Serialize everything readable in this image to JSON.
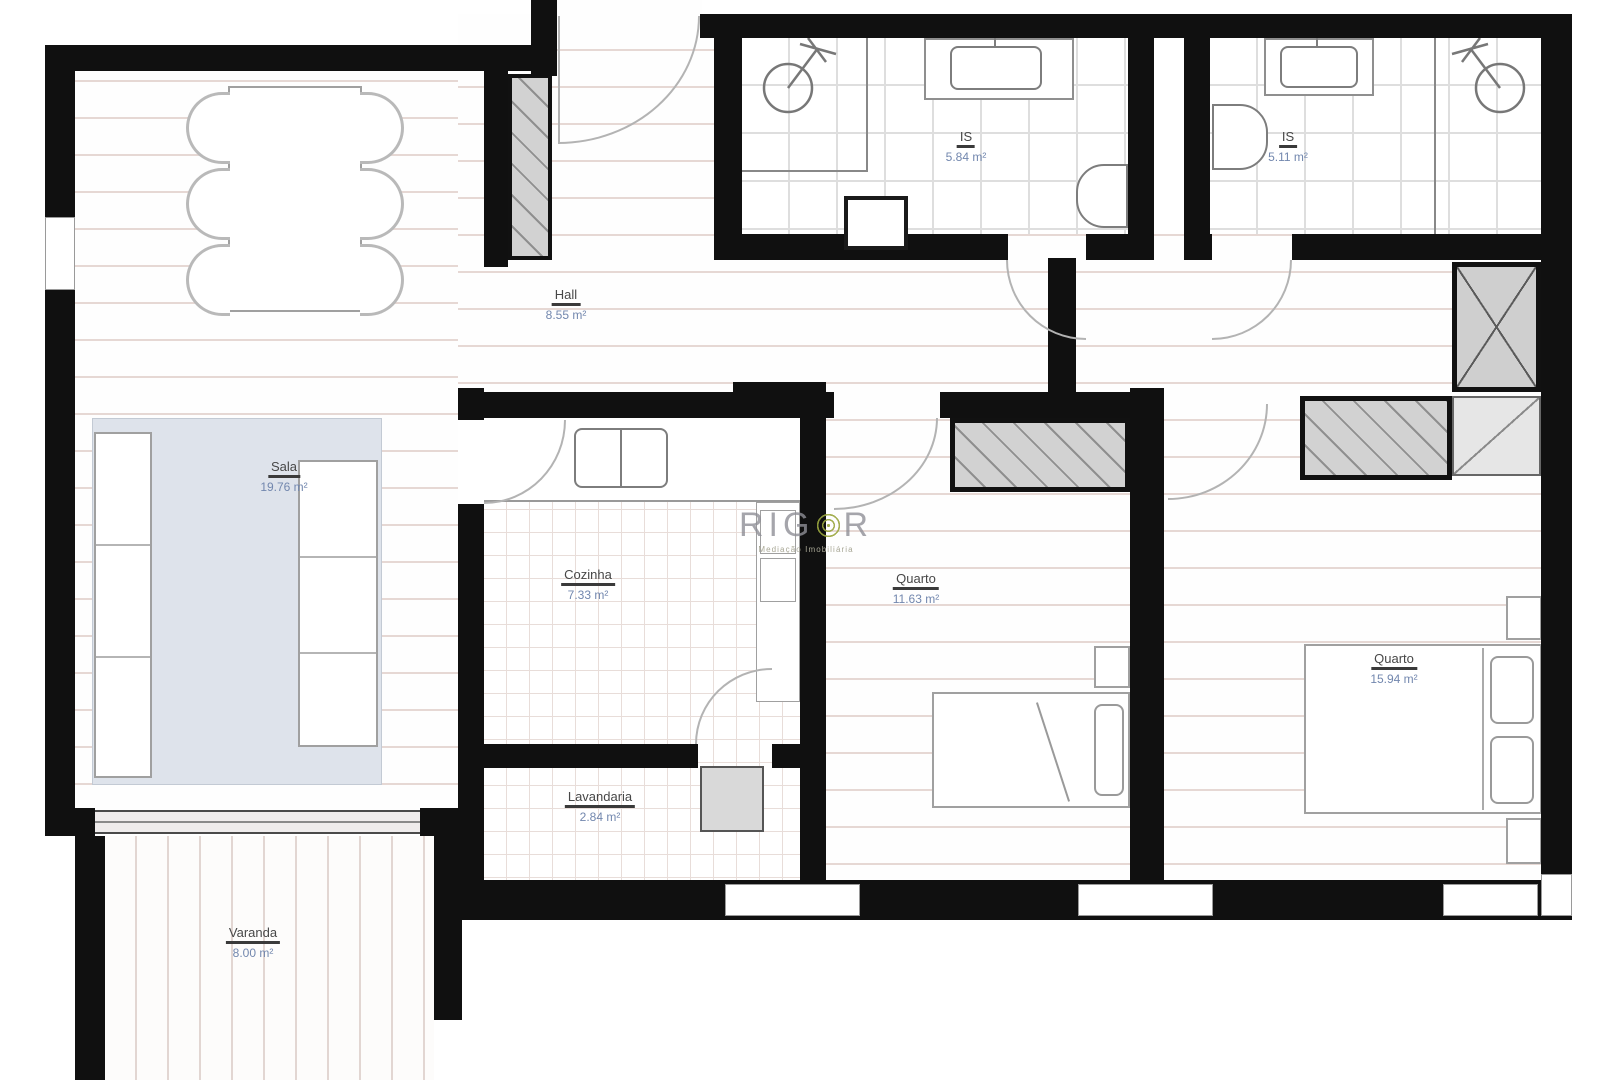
{
  "rooms": {
    "sala": {
      "name": "Sala",
      "area": "19.76 m²"
    },
    "hall": {
      "name": "Hall",
      "area": "8.55 m²"
    },
    "cozinha": {
      "name": "Cozinha",
      "area": "7.33 m²"
    },
    "lavandaria": {
      "name": "Lavandaria",
      "area": "2.84 m²"
    },
    "quarto1": {
      "name": "Quarto",
      "area": "11.63 m²"
    },
    "quarto2": {
      "name": "Quarto",
      "area": "15.94 m²"
    },
    "is1": {
      "name": "IS",
      "area": "5.84 m²"
    },
    "is2": {
      "name": "IS",
      "area": "5.11 m²"
    },
    "varanda": {
      "name": "Varanda",
      "area": "8.00 m²"
    }
  },
  "watermark": {
    "brand_prefix": "RIG",
    "brand_suffix": "R",
    "subtitle": "Mediação Imobiliária"
  },
  "colors": {
    "wall": "#101010",
    "floor_line": "#e6d8d4",
    "rug": "#dee3eb",
    "furniture_outline": "#a0a0a0",
    "wardrobe_fill": "#d2d2d2",
    "label_name": "#474747",
    "label_area": "#7287ae",
    "watermark_gray": "#8f8f96",
    "watermark_green": "#9aa63e"
  }
}
